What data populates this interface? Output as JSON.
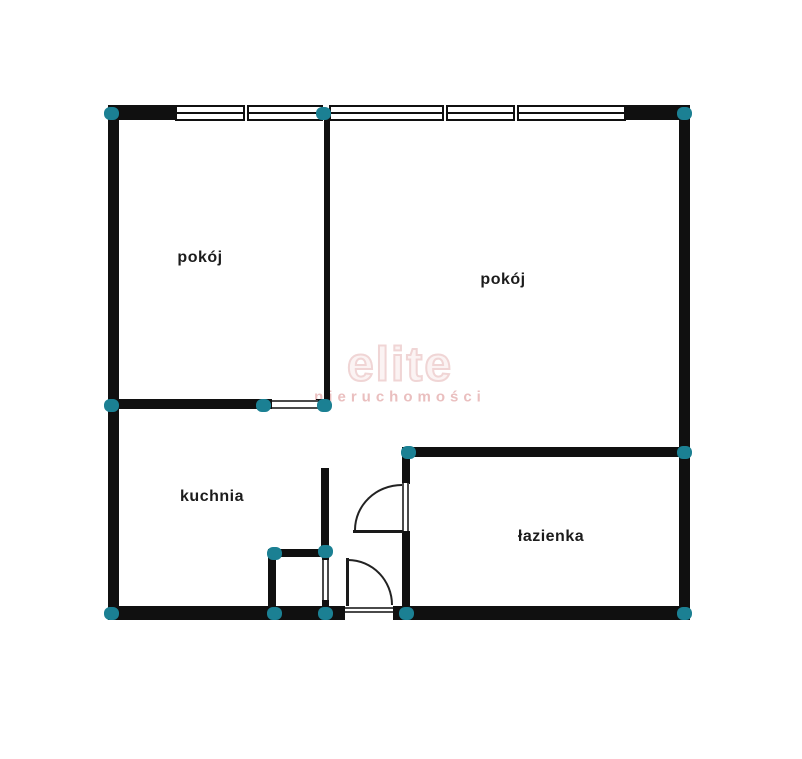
{
  "plan": {
    "rooms": [
      {
        "id": "room-left",
        "label": "pokój"
      },
      {
        "id": "room-right",
        "label": "pokój"
      },
      {
        "id": "kitchen",
        "label": "kuchnia"
      },
      {
        "id": "bathroom",
        "label": "łazienka"
      }
    ],
    "watermark": {
      "line1": "elite",
      "line2": "nieruchomości"
    },
    "colors": {
      "background": "#ffffff",
      "wall": "#101010",
      "node": "#1b8093",
      "label": "#1c1c1c",
      "watermark_fill": "#fbf3f3",
      "watermark1": "#f0d5d5",
      "watermark2": "#eabfbf"
    }
  }
}
